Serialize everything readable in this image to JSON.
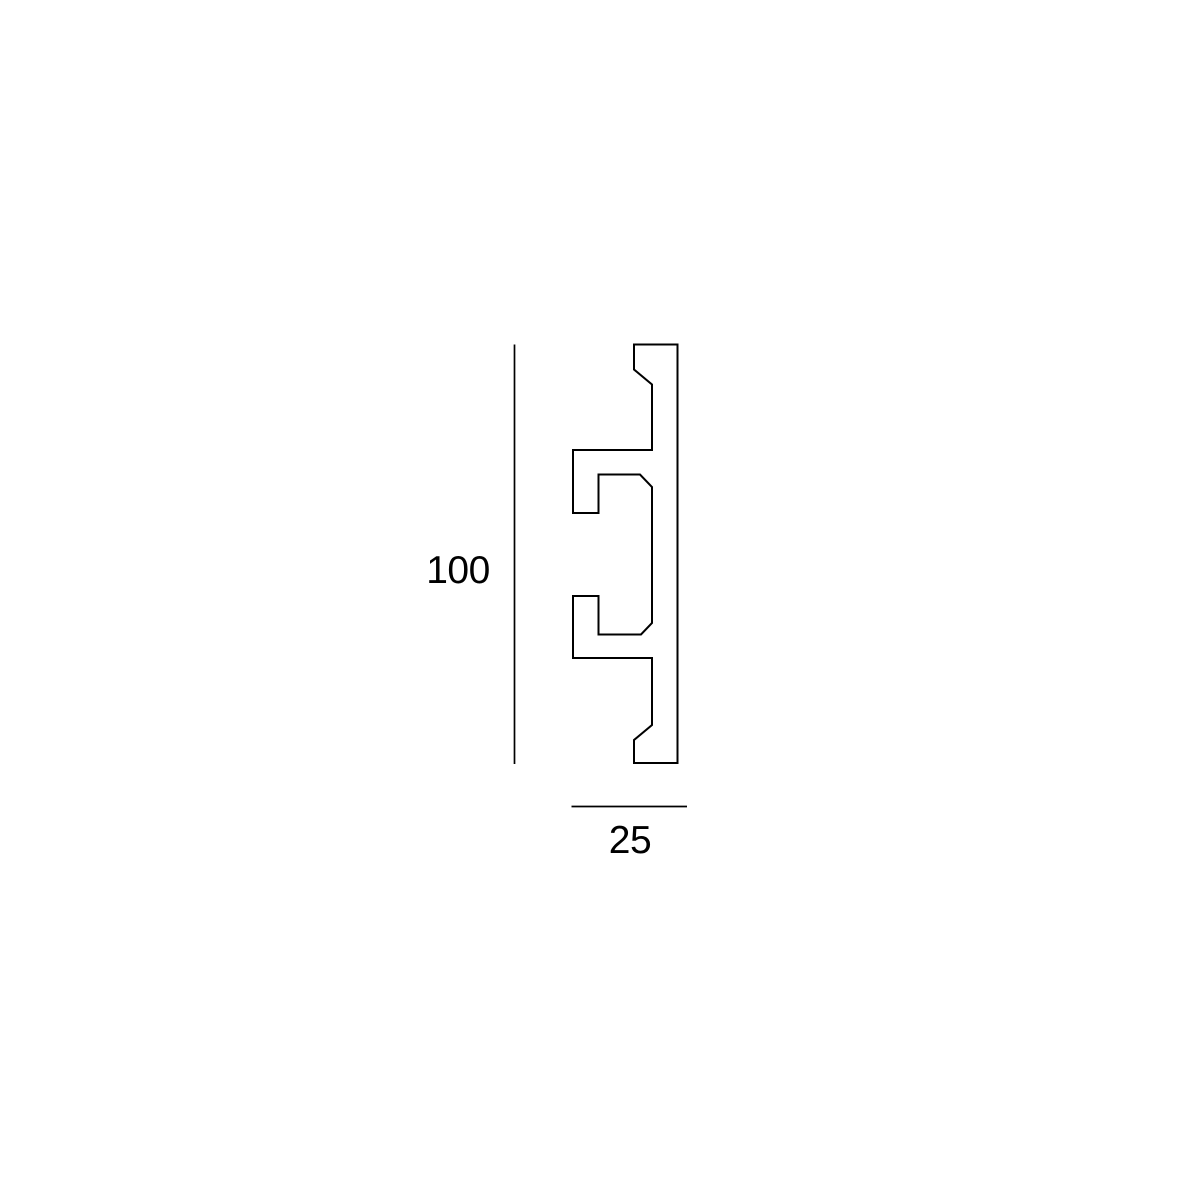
{
  "drawing": {
    "type": "technical-profile-cross-section",
    "background_color": "#ffffff",
    "stroke_color": "#000000",
    "profile": {
      "stroke_width": 2,
      "points": [
        [
          634,
          344.5
        ],
        [
          677.5,
          344.5
        ],
        [
          677.5,
          763
        ],
        [
          634,
          763
        ],
        [
          634,
          740
        ],
        [
          652,
          725
        ],
        [
          652,
          658
        ],
        [
          573,
          658
        ],
        [
          573,
          596
        ],
        [
          598.5,
          596
        ],
        [
          598.5,
          634.5
        ],
        [
          641,
          634.5
        ],
        [
          652,
          623
        ],
        [
          652,
          487
        ],
        [
          640,
          474.5
        ],
        [
          598.5,
          474.5
        ],
        [
          598.5,
          513
        ],
        [
          573,
          513
        ],
        [
          573,
          450
        ],
        [
          652,
          450
        ],
        [
          652,
          384.5
        ],
        [
          634,
          369.5
        ]
      ]
    },
    "dimensions": [
      {
        "label": "100",
        "orientation": "vertical",
        "line": {
          "x1": 514.5,
          "y1": 344.5,
          "x2": 514.5,
          "y2": 764,
          "stroke_width": 1.7
        },
        "label_pos": {
          "x": 458,
          "y": 571
        }
      },
      {
        "label": "25",
        "orientation": "horizontal",
        "line": {
          "x1": 571.5,
          "y1": 806.5,
          "x2": 687,
          "y2": 806.5,
          "stroke_width": 1.7
        },
        "label_pos": {
          "x": 630,
          "y": 841
        }
      }
    ]
  }
}
